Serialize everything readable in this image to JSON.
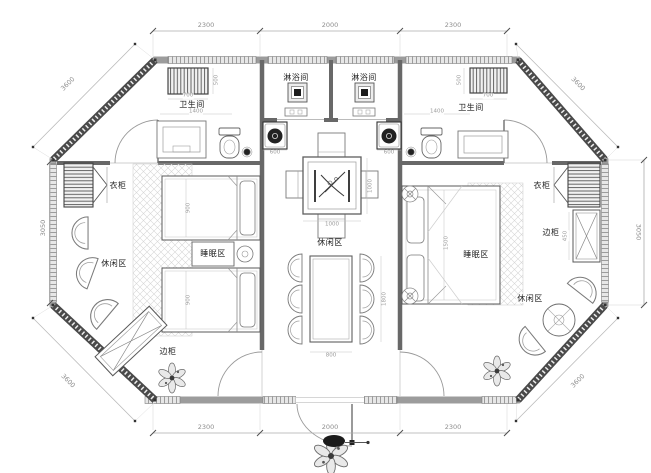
{
  "rooms": {
    "shower": "淋浴间",
    "bathroom": "卫生间",
    "wardrobe": "衣柜",
    "side_cabinet": "边柜",
    "leisure_zone": "休闲区",
    "sleep_zone": "睡眠区"
  },
  "dimensions": {
    "top": {
      "left": "2300",
      "center": "2000",
      "right": "2300"
    },
    "bottom": {
      "left": "2300",
      "center": "2000",
      "right": "2300"
    },
    "left_side": "3050",
    "right_side": "3050",
    "diagonal": "3600",
    "interior": {
      "radiator_width": "700",
      "radiator_depth": "500",
      "bath_width": "1400",
      "washer_width": "600",
      "bed_width": "900",
      "tea_table": "1000",
      "dining_width": "800",
      "dining_length": "1800",
      "double_bed": "1500",
      "cabinet_depth": "450"
    }
  },
  "palette": {
    "wall_dark": "#4a4a4a",
    "wall_gray": "#9c9c9c",
    "line": "#777777",
    "dim_text": "#8d8d8d",
    "paper": "#ffffff",
    "dark_fill": "#1d1d1d"
  }
}
